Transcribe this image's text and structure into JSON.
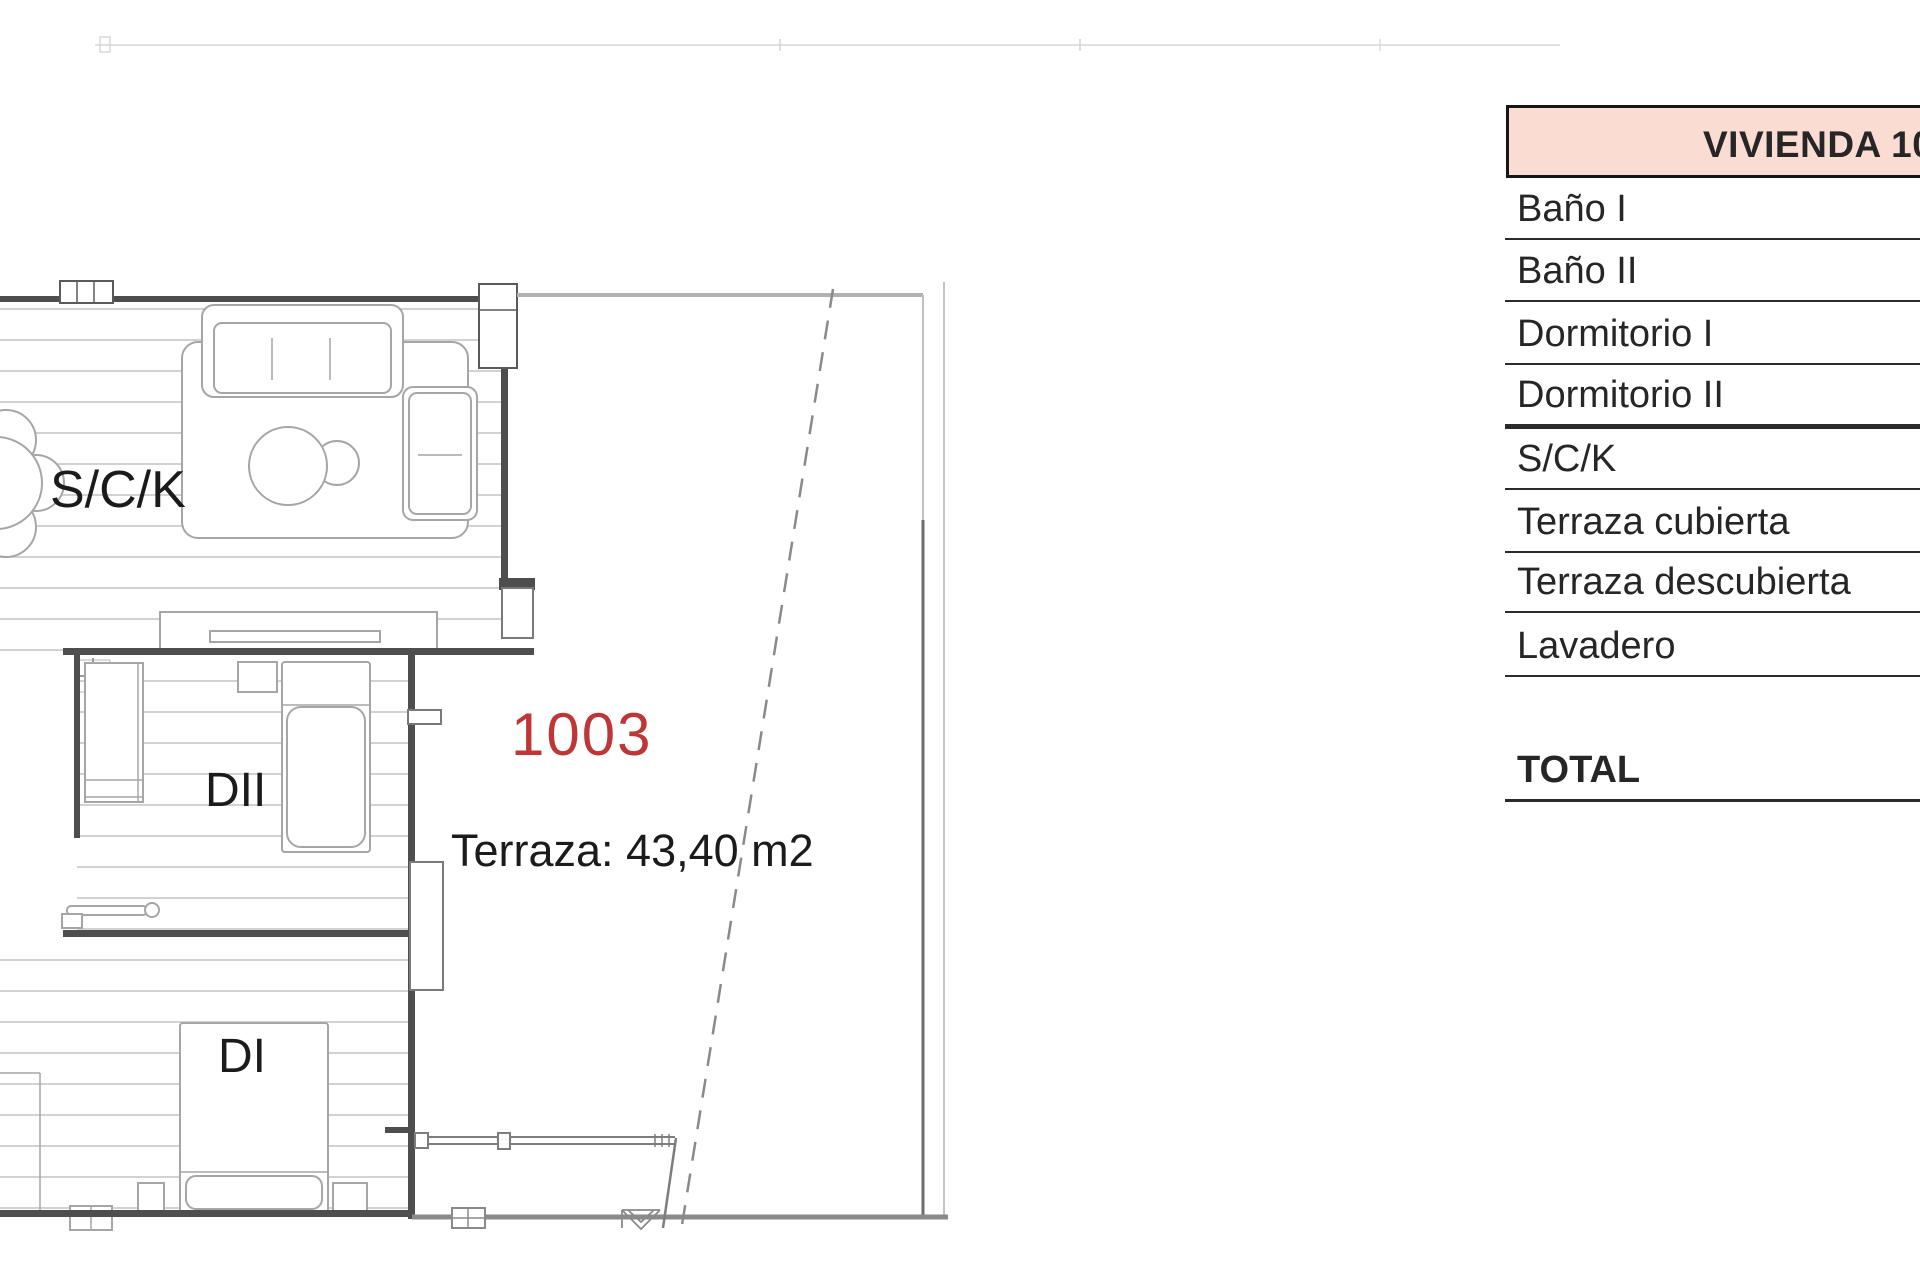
{
  "plan": {
    "unit_number": "1003",
    "terrace_measure_label": "Terraza: 43,40 m2",
    "room_labels": {
      "living": "S/C/K",
      "bedroom2": "DII",
      "bedroom1": "DI"
    },
    "colors": {
      "unit_number_red": "#bf3636",
      "wall_dark": "#4e4e4e",
      "furniture_line": "#a6a6a6",
      "boundary_gray": "#9a9a9a"
    }
  },
  "table": {
    "header": "VIVIENDA 10",
    "header_fill": "#fadcd3",
    "rows": [
      {
        "label": "Baño I"
      },
      {
        "label": "Baño II"
      },
      {
        "label": "Dormitorio I"
      },
      {
        "label": "Dormitorio II"
      },
      {
        "label": "S/C/K"
      },
      {
        "label": "Terraza cubierta"
      },
      {
        "label": "Terraza descubierta"
      },
      {
        "label": "Lavadero"
      }
    ],
    "total_label": "TOTAL"
  }
}
